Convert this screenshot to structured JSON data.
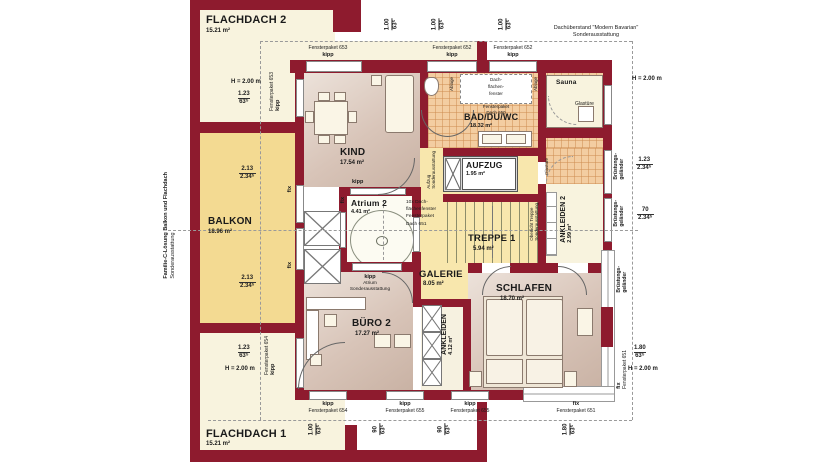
{
  "colors": {
    "wall": "#8e1b2e",
    "flat_roof": "#f8f3de",
    "balcony": "#f3da92",
    "hallway": "#f8e7ad",
    "room_floor": "#d8c4b8",
    "bath_tile": "#f3cda1"
  },
  "rooms": {
    "flachdach2": {
      "name": "FLACHDACH 2",
      "area": "15.21 m²"
    },
    "flachdach1": {
      "name": "FLACHDACH 1",
      "area": "15.21 m²"
    },
    "balkon": {
      "name": "BALKON",
      "area": "18.96 m²"
    },
    "kind": {
      "name": "KIND",
      "area": "17.54 m²"
    },
    "bad": {
      "name": "BAD/DU/WC",
      "area": "18.32 m²"
    },
    "sauna": {
      "name": "Sauna"
    },
    "aufzug": {
      "name": "AUFZUG",
      "area": "1.95 m²"
    },
    "atrium": {
      "name": "Atrium 2",
      "area": "4.41 m²"
    },
    "treppe": {
      "name": "TREPPE 1",
      "area": "5.94 m²"
    },
    "galerie": {
      "name": "GALERIE",
      "area": "8.05 m²"
    },
    "buero": {
      "name": "BÜRO 2",
      "area": "17.27 m²"
    },
    "ankleiden": {
      "name": "ANKLEIDEN",
      "area": "4.12 m²"
    },
    "ankleiden2": {
      "name": "ANKLEIDEN 2",
      "area": "2.99 m²"
    },
    "schlafen": {
      "name": "SCHLAFEN",
      "area": "18.70 m²"
    }
  },
  "windows": {
    "kipp": "kipp",
    "fix": "fix",
    "fp651": "Fensterpaket 651",
    "fp652": "Fensterpaket 652",
    "fp653": "Fensterpaket 653",
    "fp654": "Fensterpaket 654",
    "fp655": "Fensterpaket 655"
  },
  "dims": {
    "v100": "1.00",
    "v63": "63⁵",
    "v123": "1.23",
    "v234": "2.34⁵",
    "v213": "2.13",
    "v70": "70",
    "v180": "1.80",
    "v90": "90",
    "h200": "H = 2.00 m"
  },
  "notes": {
    "side1": "Familie-C-Lösung Balkon und Flachdach",
    "side2": "Sonderausstattung",
    "dach1": "Dachüberstand \"Modern Bavarian\"",
    "dach2": "Sonderausstattung",
    "bruestung1": "Brüstungs-",
    "bruestung2": "geländer",
    "oberlicht1": "Oberlicht Treppe",
    "oberlicht2": "Sonderausstattung",
    "aufzug1": "Aufzug",
    "aufzug2": "Sonderausstattung",
    "atrium1": "kipp",
    "atrium2": "Atrium",
    "atrium3": "Sonderausstattung",
    "roof650a": "Dach-",
    "roof650b": "flächen-",
    "roof650c": "fenster",
    "roof650d": "Fensterpaket",
    "roof650e": "Dach 650",
    "roof651a": "10x Dach-",
    "roof651b": "flächenfenster",
    "roof651c": "Fensterpaket",
    "roof651d": "Dach 651",
    "glastuere": "Glastüre",
    "ablage": "Ablage"
  }
}
